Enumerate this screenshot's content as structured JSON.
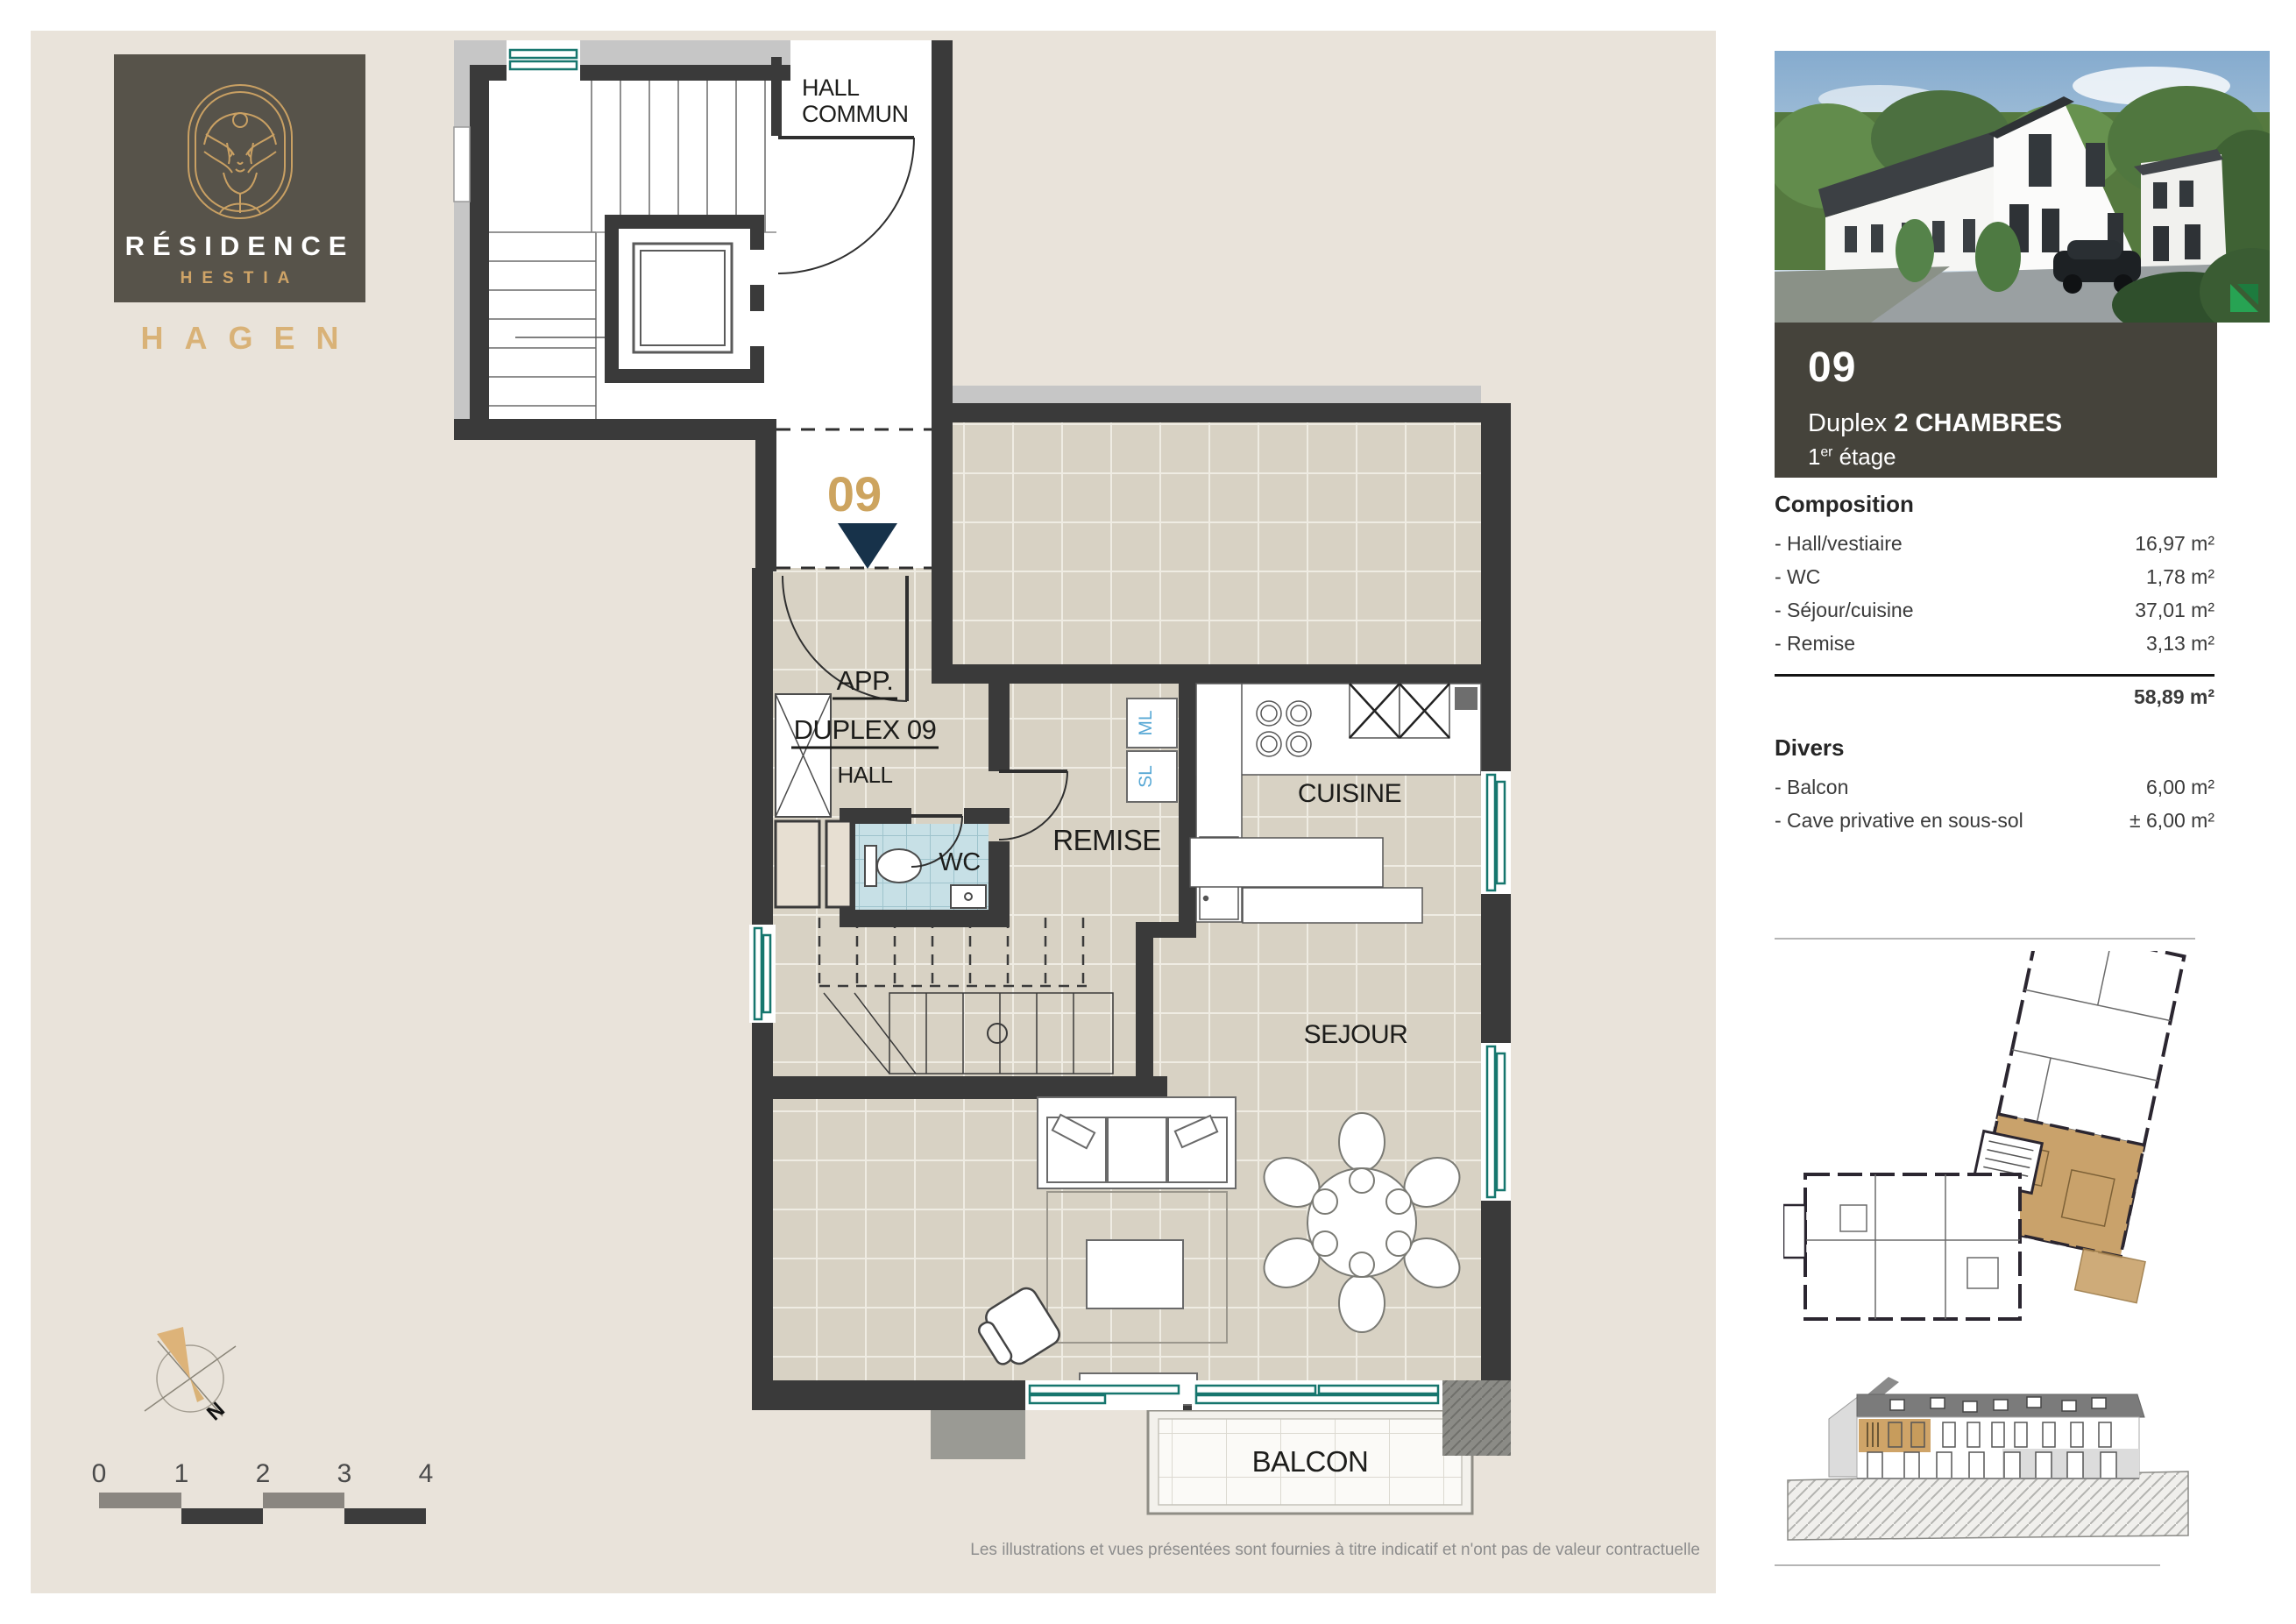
{
  "branding": {
    "residence": "RÉSIDENCE",
    "name": "HESTIA",
    "city": "HAGEN"
  },
  "plan": {
    "hall_commun_1": "HALL",
    "hall_commun_2": "COMMUN",
    "unit_number": "09",
    "app_1": "APP.",
    "app_2": "DUPLEX 09",
    "hall": "HALL",
    "wc": "WC",
    "ml": "ML",
    "sl": "SL",
    "remise": "REMISE",
    "cuisine": "CUISINE",
    "sejour": "SEJOUR",
    "balcon": "BALCON"
  },
  "compass": {
    "north": "N"
  },
  "scale_bar": {
    "ticks": [
      "0",
      "1",
      "2",
      "3",
      "4"
    ]
  },
  "sidebar": {
    "unit_number": "09",
    "unit_type_regular": "Duplex ",
    "unit_type_bold": "2 CHAMBRES",
    "floor_number": "1",
    "floor_suffix": "er",
    "floor_word": " étage",
    "composition": {
      "title": "Composition",
      "items": [
        {
          "label": "- Hall/vestiaire",
          "value": "16,97 m²"
        },
        {
          "label": "- WC",
          "value": "1,78 m²"
        },
        {
          "label": "- Séjour/cuisine",
          "value": "37,01 m²"
        },
        {
          "label": "- Remise",
          "value": "3,13 m²"
        }
      ],
      "total": "58,89 m²"
    },
    "divers": {
      "title": "Divers",
      "items": [
        {
          "label": "- Balcon",
          "value": "6,00 m²"
        },
        {
          "label": "- Cave privative en sous-sol",
          "value": "± 6,00 m²"
        }
      ]
    }
  },
  "footer": {
    "disclaimer": "Les illustrations et vues présentées sont fournies à titre indicatif et n'ont pas de valeur contractuelle"
  },
  "colors": {
    "accent_gold": "#cda45f",
    "wall_dark": "#3a3a3a",
    "window_teal": "#16766e",
    "navy": "#17324a",
    "highlight_tan": "#c9a26b"
  }
}
